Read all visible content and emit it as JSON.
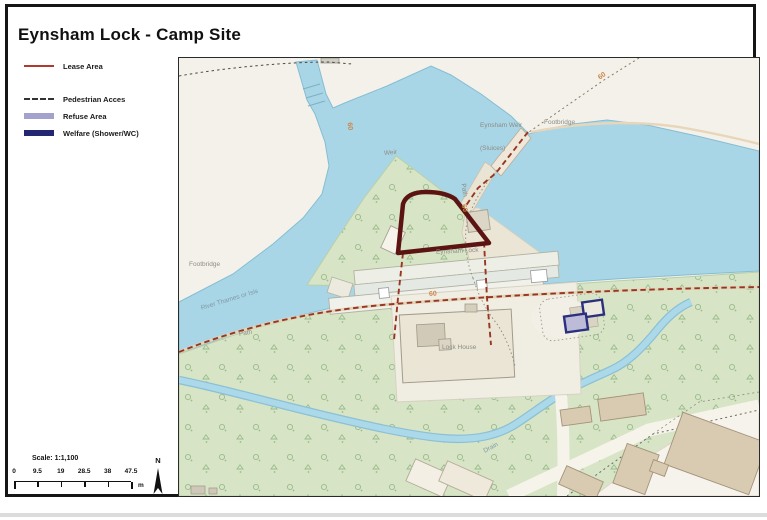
{
  "title": "Eynsham Lock - Camp Site",
  "legend": {
    "items": [
      {
        "label": "Lease Area",
        "type": "line-thin",
        "color": "#b2392e"
      },
      {
        "label": "Pedestrian Acces",
        "type": "line-dashed",
        "color": "#333333"
      },
      {
        "label": "Refuse Area",
        "type": "line-thick",
        "color": "#a2a2cc"
      },
      {
        "label": "Welfare (Shower/WC)",
        "type": "line-thick",
        "color": "#232771"
      }
    ]
  },
  "scalebar": {
    "title": "Scale: 1:1,100",
    "ticks": [
      "0",
      "9.5",
      "19",
      "28.5",
      "38",
      "47.5"
    ],
    "unit": "m"
  },
  "north_label": "N",
  "map": {
    "labels": [
      {
        "text": "Weir",
        "x": 205,
        "y": 92,
        "rot": -5,
        "cls": "gray"
      },
      {
        "text": "Eynsham Weir",
        "x": 301,
        "y": 64,
        "rot": 0,
        "cls": "gray"
      },
      {
        "text": "(Sluices)",
        "x": 301,
        "y": 87,
        "rot": 0,
        "cls": "gray"
      },
      {
        "text": "Footbridge",
        "x": 365,
        "y": 61,
        "rot": 0,
        "cls": "gray"
      },
      {
        "text": "Footbridge",
        "x": 10,
        "y": 203,
        "rot": 0,
        "cls": "gray"
      },
      {
        "text": "River Thames or Isis",
        "x": 22,
        "y": 247,
        "rot": -17,
        "cls": "water"
      },
      {
        "text": "Path",
        "x": 60,
        "y": 273,
        "rot": -10,
        "cls": "gray"
      },
      {
        "text": "Path",
        "x": 284,
        "y": 122,
        "rot": 82,
        "cls": "gray"
      },
      {
        "text": "Eynsham Lock",
        "x": 257,
        "y": 191,
        "rot": -3,
        "cls": "gray"
      },
      {
        "text": "Lock House",
        "x": 263,
        "y": 286,
        "rot": 0,
        "cls": "gray"
      },
      {
        "text": "Drain",
        "x": 305,
        "y": 390,
        "rot": -28,
        "cls": "water"
      }
    ],
    "contour_labels": [
      {
        "text": "60",
        "x": 170,
        "y": 61,
        "rot": 82
      },
      {
        "text": "60",
        "x": 420,
        "y": 17,
        "rot": -35
      },
      {
        "text": "60",
        "x": 284,
        "y": 143,
        "rot": 75
      },
      {
        "text": "60",
        "x": 250,
        "y": 233,
        "rot": -4
      }
    ]
  }
}
